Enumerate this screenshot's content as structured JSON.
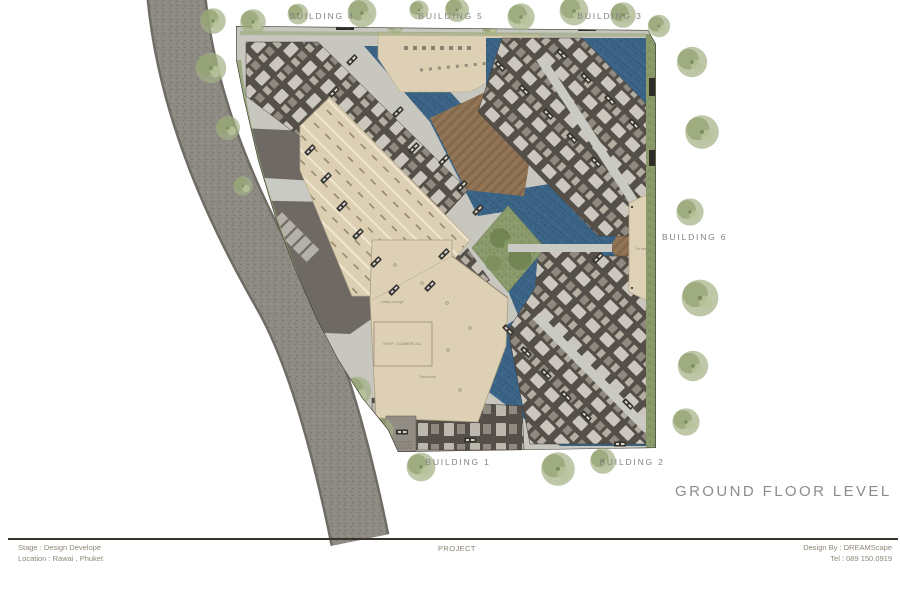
{
  "labels": {
    "building1": "BUILDING 1",
    "building2": "BUILDING 2",
    "building3": "BUILDING 3",
    "building4": "BUILDING 4",
    "building5": "BUILDING 5",
    "building6": "BUILDING 6"
  },
  "title": "GROUND FLOOR LEVEL",
  "annotations": {
    "lobby": "Lobby lounge",
    "shop": "SHOP / COMMERCIAL",
    "restroom": "Restroom",
    "pavilion": "On meeting"
  },
  "title_block": {
    "stage": "Stage : Design Develope",
    "location": "Location : Rawai , Phuket",
    "project": "PROJECT",
    "design_by": "Design By :  DREAMScape",
    "tel": "Tel  :  089 150.0919"
  },
  "colors": {
    "pool": "#3b6486",
    "roof": "#544f49",
    "beige": "#ddd0b5",
    "deck": "#8d7152",
    "road": "#8e8b85",
    "asphalt": "#6e6a63",
    "lawn": "#8a9a6b",
    "label_gray": "#84837d"
  }
}
